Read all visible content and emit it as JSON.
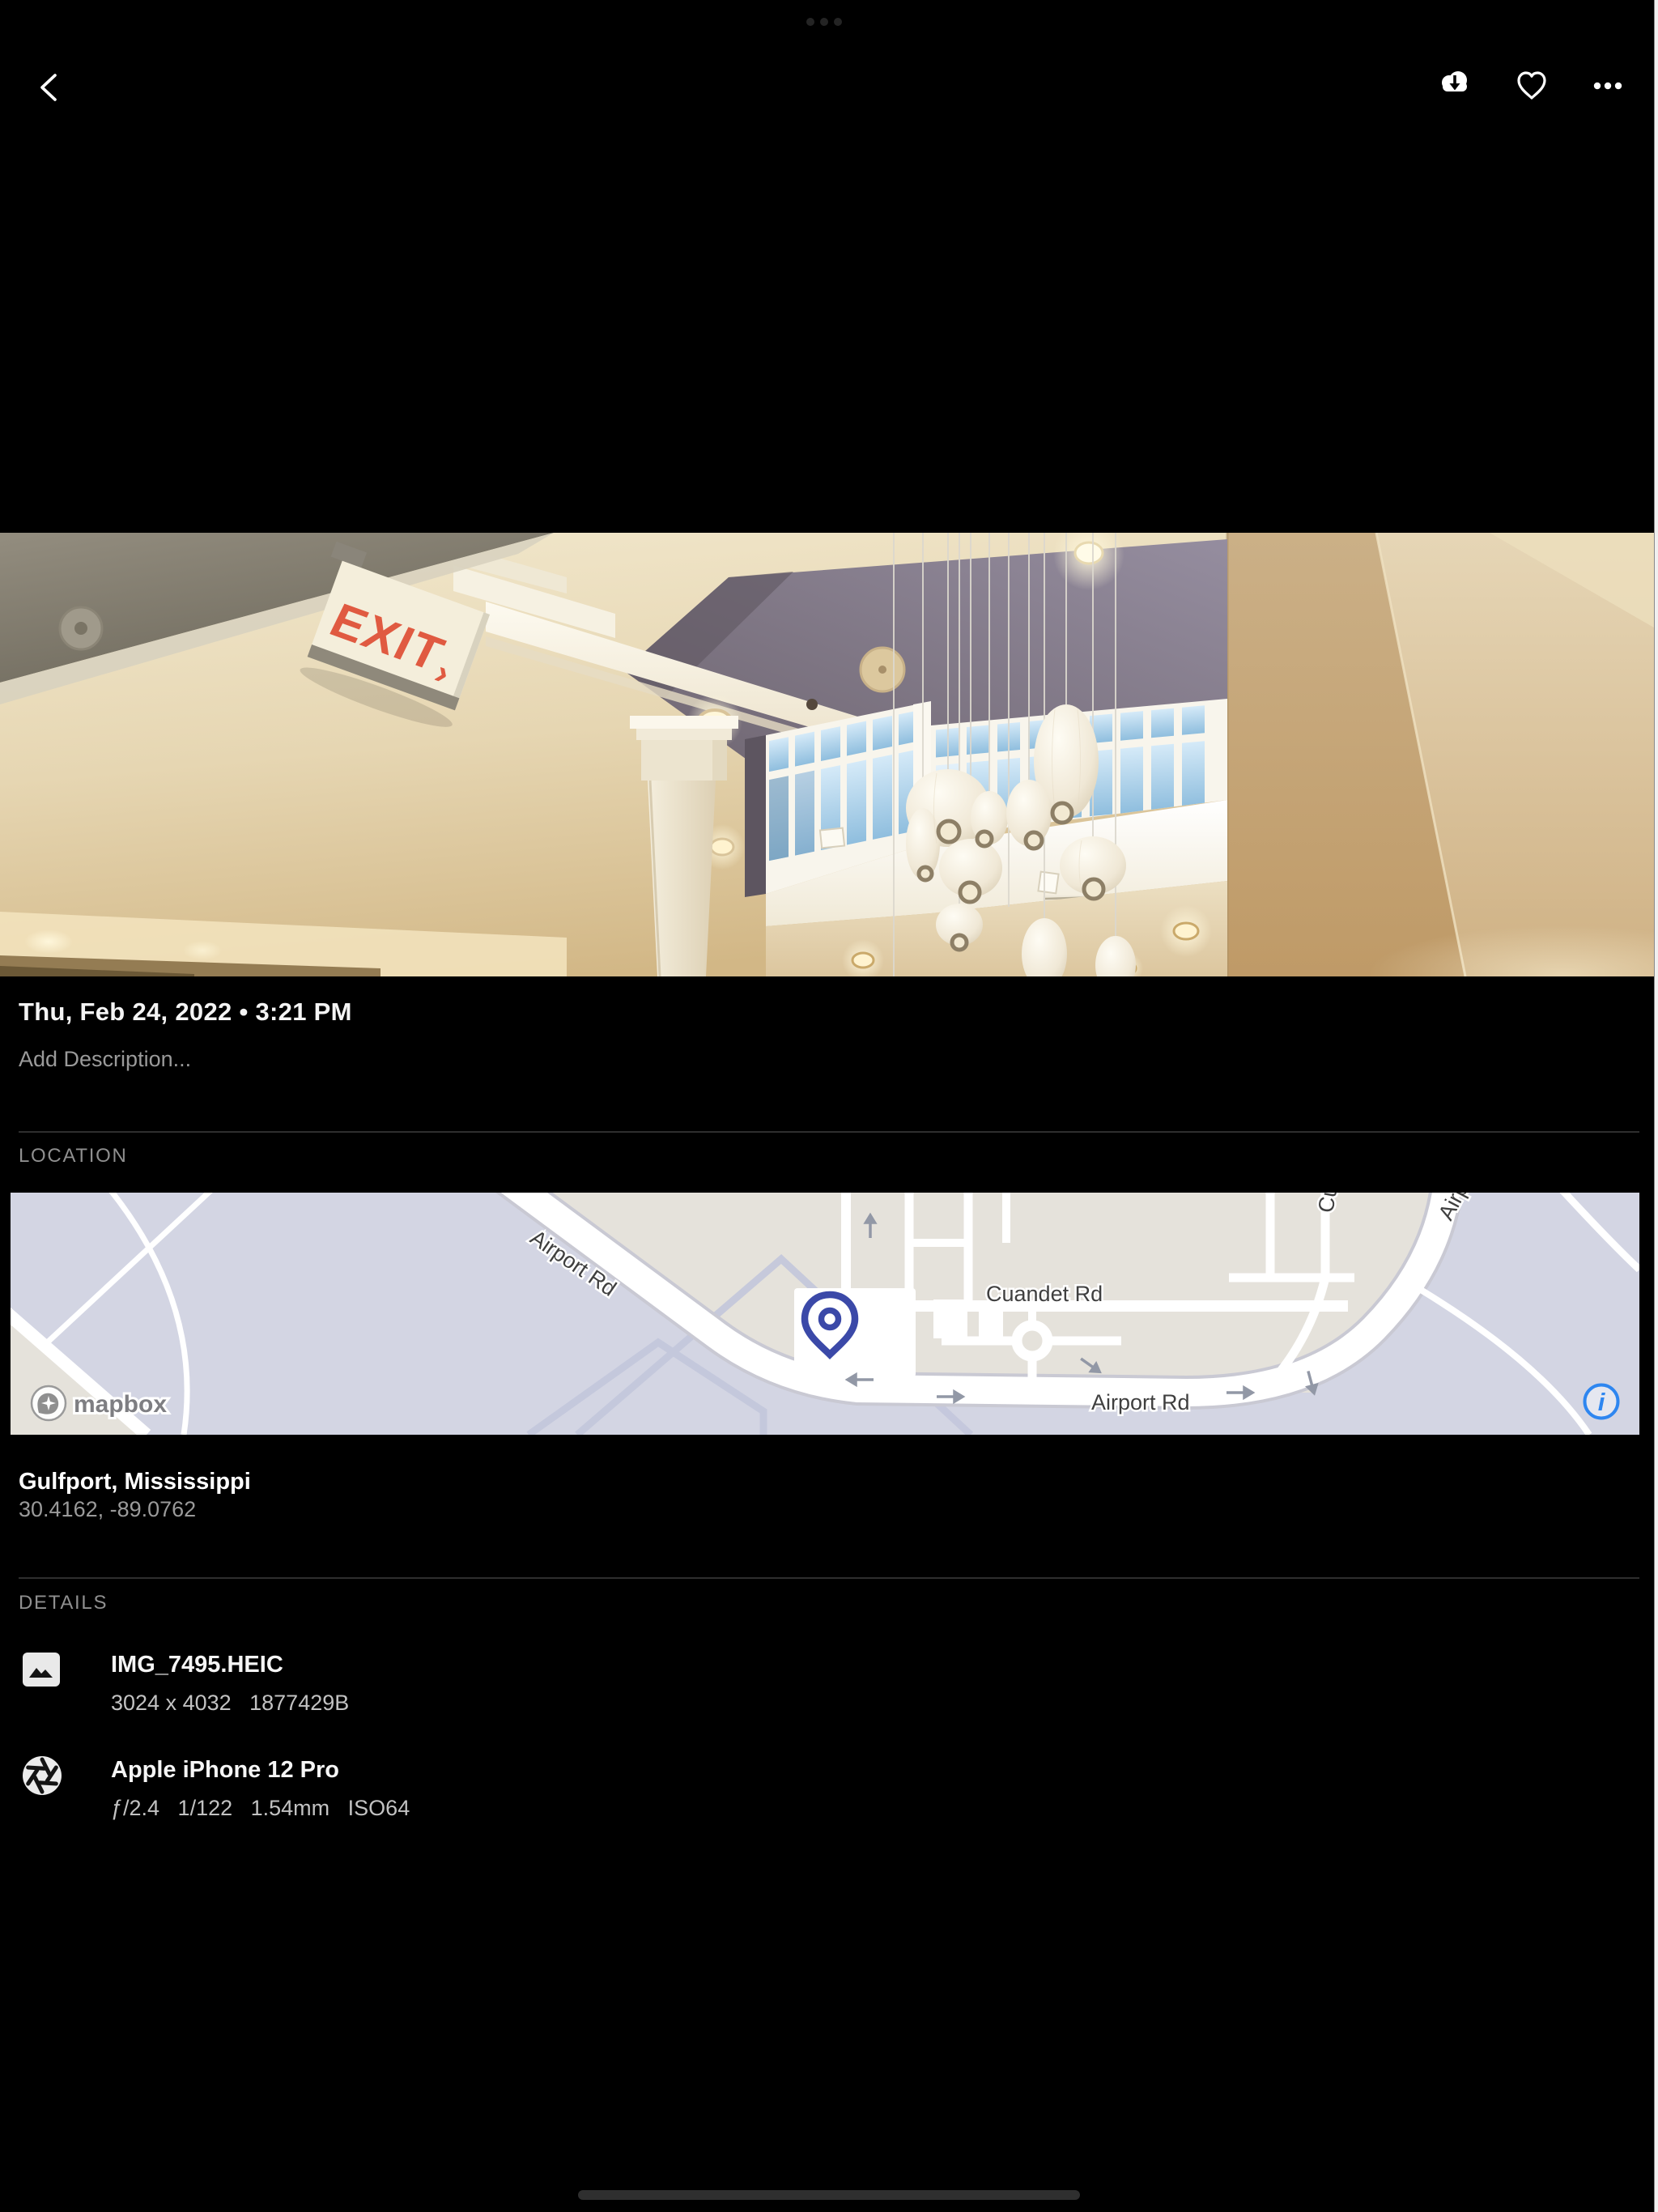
{
  "status_bar": {
    "multitask_indicator_icon": "three-dots"
  },
  "top_bar": {
    "back_icon": "chevron-left",
    "download_icon": "cloud-download",
    "favorite_icon": "heart-outline",
    "more_icon": "ellipsis-horizontal"
  },
  "photo": {
    "exit_sign_text": "EXIT",
    "exit_sign_arrow": "›",
    "scene": "interior atrium ceiling with pendant lamps and exit sign"
  },
  "info": {
    "date": "Thu, Feb 24, 2022 • 3:21 PM",
    "description_placeholder": "Add Description..."
  },
  "location": {
    "section_label": "LOCATION",
    "place": "Gulfport, Mississippi",
    "coordinates": "30.4162, -89.0762",
    "map": {
      "labels": {
        "airport_rd": "Airport Rd",
        "cuandet_rd": "Cuandet Rd"
      },
      "attribution": "mapbox",
      "info_glyph": "i"
    }
  },
  "details": {
    "section_label": "DETAILS",
    "rows": [
      {
        "icon": "image",
        "title": "IMG_7495.HEIC",
        "subtitle": "3024 x 4032   1877429B"
      },
      {
        "icon": "aperture",
        "title": "Apple iPhone 12 Pro",
        "subtitle": "ƒ/2.4   1/122   1.54mm   ISO64"
      }
    ]
  },
  "colors": {
    "background": "#000000",
    "accent_blue": "#2e86f0",
    "pin_indigo": "#3b49a8",
    "map_beige": "#e5e2db",
    "map_lavender": "#d3d5e3",
    "exit_red": "#e05a41"
  }
}
